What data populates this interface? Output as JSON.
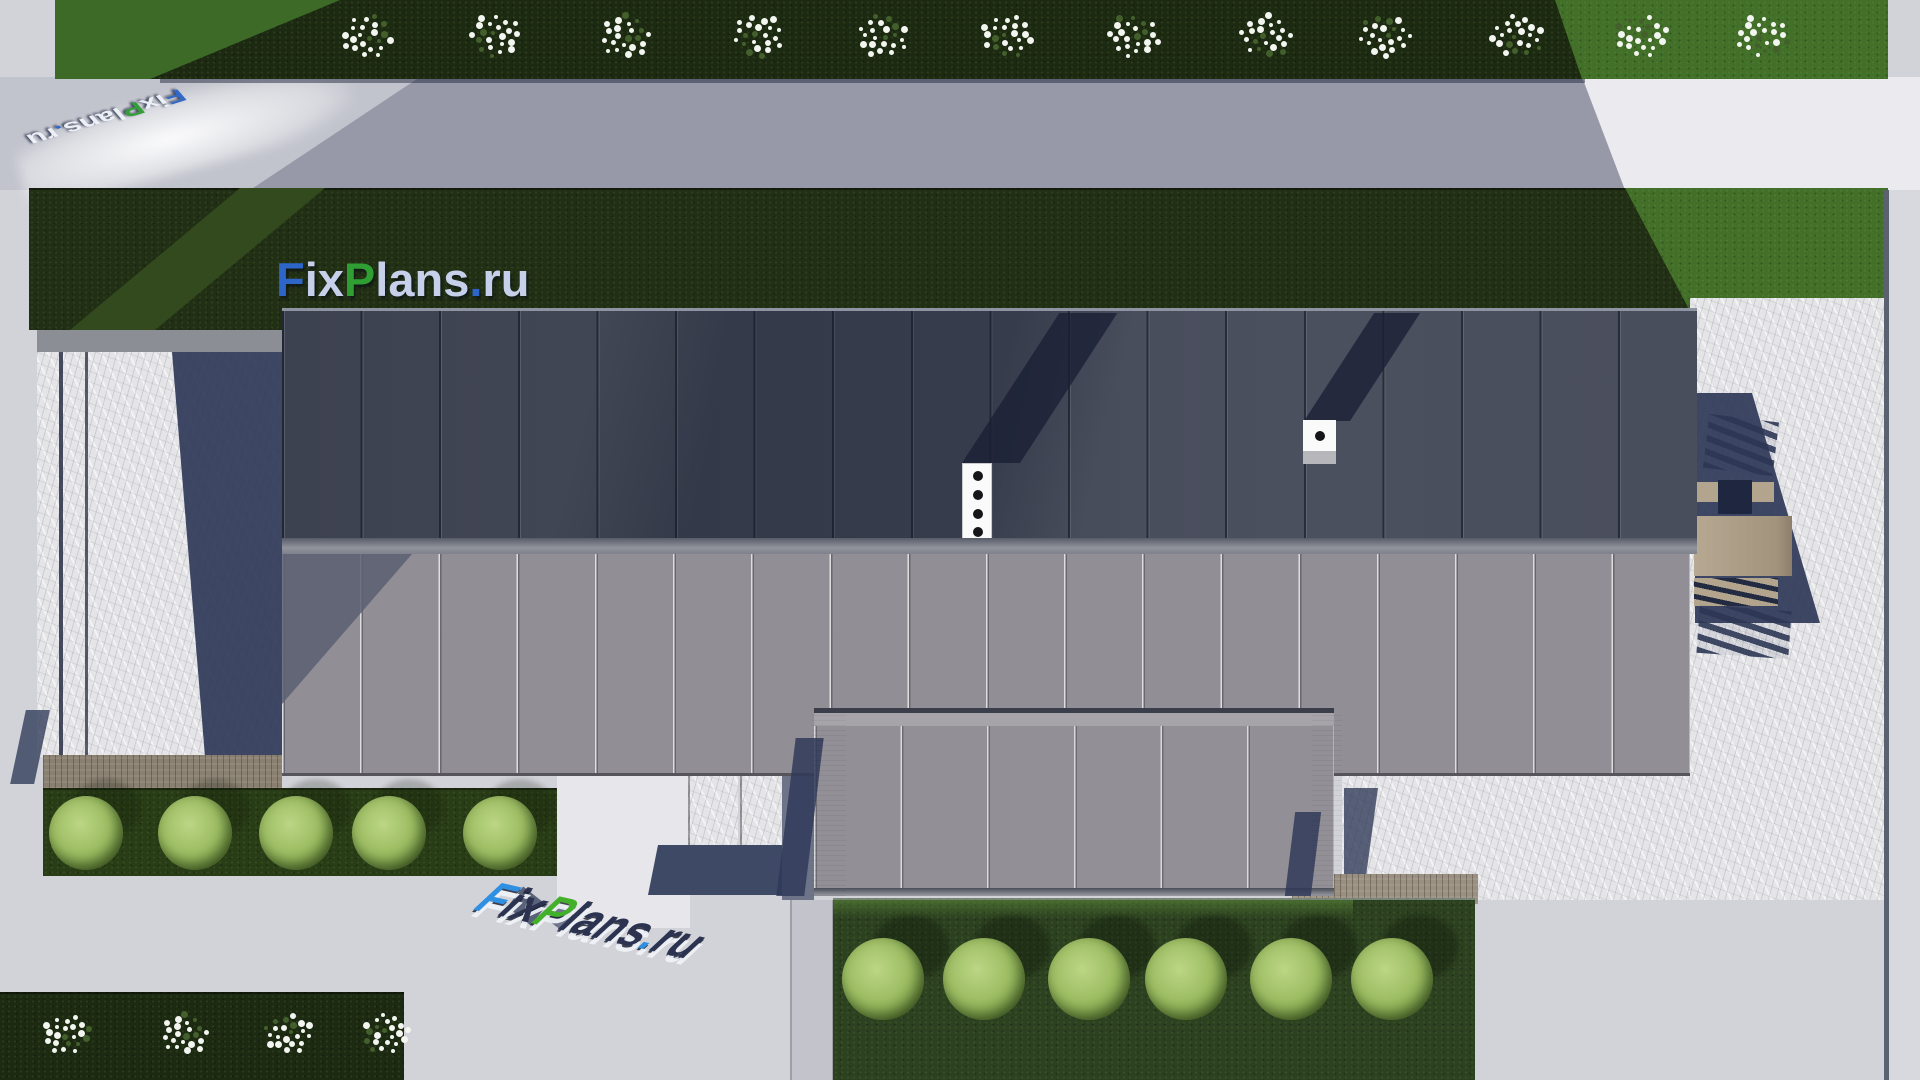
{
  "watermark": {
    "text": "FixPlans.ru",
    "letters": [
      {
        "ch": "F",
        "tone": "blue"
      },
      {
        "ch": "i",
        "tone": "light"
      },
      {
        "ch": "x",
        "tone": "light"
      },
      {
        "ch": "P",
        "tone": "green"
      },
      {
        "ch": "l",
        "tone": "light"
      },
      {
        "ch": "a",
        "tone": "light"
      },
      {
        "ch": "n",
        "tone": "light"
      },
      {
        "ch": "s",
        "tone": "light"
      },
      {
        "ch": ".",
        "tone": "blue"
      },
      {
        "ch": "r",
        "tone": "light"
      },
      {
        "ch": "u",
        "tone": "light"
      }
    ],
    "colors": {
      "blue": "#2d66c8",
      "green": "#2f9e33",
      "light": "#c6d0ea",
      "ground_white": "#eef1f8",
      "ground_navy": "#2b3350",
      "ground_blue": "#2f8fe0",
      "ground_green": "#43b02c"
    }
  },
  "scene": {
    "description": "Top-down 3D architectural site render: flat-roof house, lawns, stone patios, tree rows, FixPlans.ru watermarks",
    "palette": {
      "pavement": "#d2d3d9",
      "pavement_sunlit": "#ebebef",
      "pavement_shadow": "#9799a8",
      "grass_shadow": "#1d2a12",
      "grass_mid": "#2c4120",
      "grass_sunlit": "#427029",
      "roof_upper": "#454a59",
      "roof_lower": "#918f95",
      "shadow_navy": "#333d5e",
      "stone": "#e5e5e8",
      "wood": "#8a8071",
      "tree_green": "#9dbd63"
    },
    "shrubs_top": {
      "y": 36,
      "radius": 26,
      "xs": [
        367,
        496,
        625,
        759,
        882,
        1008,
        1133,
        1267,
        1384,
        1518,
        1641,
        1763
      ]
    },
    "shrubs_corner": {
      "y": 1034,
      "radius": 24,
      "xs": [
        67,
        184,
        288,
        386
      ]
    },
    "trees_row1": {
      "y": 831,
      "r": 37,
      "xs": [
        86,
        195,
        296,
        389,
        500
      ]
    },
    "trees_row2": {
      "y": 977,
      "r": 41,
      "xs": [
        883,
        984,
        1089,
        1186,
        1291,
        1392
      ]
    },
    "roof": {
      "upper_panels": 18,
      "lower_panels": 18,
      "wing_panels": 6
    },
    "vents": {
      "strip_holes": 5,
      "box_holes": 1
    }
  }
}
